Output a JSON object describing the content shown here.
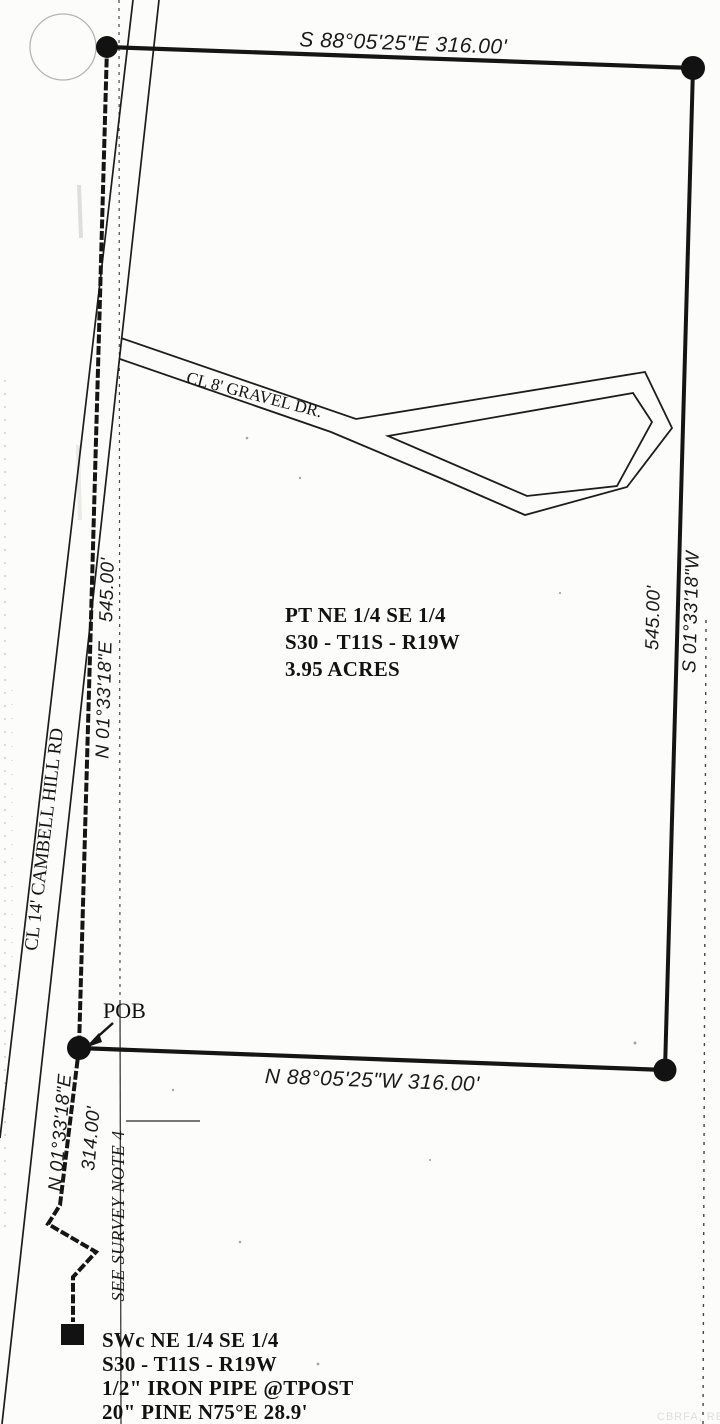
{
  "plat": {
    "north_line_label": "S 88°05'25\"E 316.00'",
    "south_line_label": "N 88°05'25\"W 316.00'",
    "east_line_bearing": "S 01°33'18\"W",
    "east_line_distance": "545.00'",
    "west_line_bearing": "N 01°33'18\"E",
    "west_line_distance": "545.00'",
    "road_label": "CL 14' CAMBELL HILL RD",
    "drive_label": "CL 8' GRAVEL DR.",
    "pob_label": "POB",
    "tie_line_bearing": "N 01°33'18\"E",
    "tie_line_distance": "314.00'",
    "survey_note_label": "SEE SURVEY NOTE 4",
    "parcel": {
      "line1": "PT NE 1/4 SE 1/4",
      "line2": "S30 - T11S - R19W",
      "line3": "3.95 ACRES"
    },
    "sw_corner": {
      "line1": "SWc NE 1/4 SE 1/4",
      "line2": "S30 - T11S - R19W",
      "line3": "1/2\" IRON PIPE @TPOST",
      "line4": "20\" PINE N75°E 28.9'"
    },
    "watermark": "CBRFA, RE",
    "colors": {
      "ink": "#161616",
      "paper": "#fcfcfa",
      "faint_circle": "#b5b5b5"
    }
  }
}
